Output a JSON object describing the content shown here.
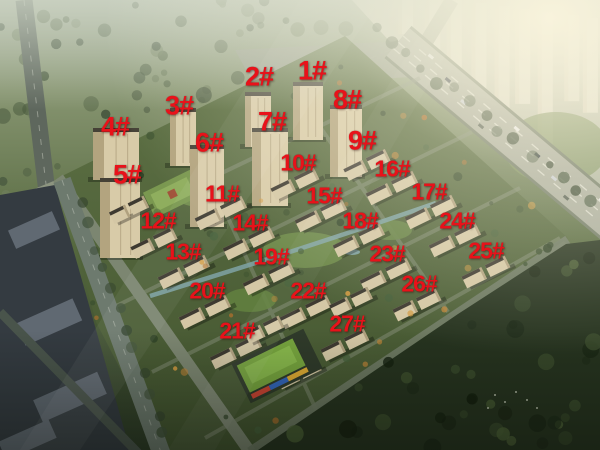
{
  "scene": {
    "type": "aerial-rendering",
    "subject": "residential compound master plan with numbered buildings",
    "marker_color": "#e8121a",
    "marker_count": 27
  },
  "markers": [
    {
      "id": 1,
      "label": "1#",
      "x": 312,
      "y": 71
    },
    {
      "id": 2,
      "label": "2#",
      "x": 259,
      "y": 77
    },
    {
      "id": 3,
      "label": "3#",
      "x": 179,
      "y": 106
    },
    {
      "id": 4,
      "label": "4#",
      "x": 115,
      "y": 127
    },
    {
      "id": 5,
      "label": "5#",
      "x": 127,
      "y": 175
    },
    {
      "id": 6,
      "label": "6#",
      "x": 209,
      "y": 143
    },
    {
      "id": 7,
      "label": "7#",
      "x": 272,
      "y": 122
    },
    {
      "id": 8,
      "label": "8#",
      "x": 347,
      "y": 100
    },
    {
      "id": 9,
      "label": "9#",
      "x": 362,
      "y": 141
    },
    {
      "id": 10,
      "label": "10#",
      "x": 298,
      "y": 163
    },
    {
      "id": 11,
      "label": "11#",
      "x": 222,
      "y": 194
    },
    {
      "id": 12,
      "label": "12#",
      "x": 158,
      "y": 221
    },
    {
      "id": 13,
      "label": "13#",
      "x": 183,
      "y": 252
    },
    {
      "id": 14,
      "label": "14#",
      "x": 250,
      "y": 223
    },
    {
      "id": 15,
      "label": "15#",
      "x": 324,
      "y": 196
    },
    {
      "id": 16,
      "label": "16#",
      "x": 392,
      "y": 169
    },
    {
      "id": 17,
      "label": "17#",
      "x": 429,
      "y": 192
    },
    {
      "id": 18,
      "label": "18#",
      "x": 360,
      "y": 221
    },
    {
      "id": 19,
      "label": "19#",
      "x": 271,
      "y": 257
    },
    {
      "id": 20,
      "label": "20#",
      "x": 207,
      "y": 291
    },
    {
      "id": 21,
      "label": "21#",
      "x": 237,
      "y": 331
    },
    {
      "id": 22,
      "label": "22#",
      "x": 308,
      "y": 291
    },
    {
      "id": 23,
      "label": "23#",
      "x": 387,
      "y": 254
    },
    {
      "id": 24,
      "label": "24#",
      "x": 457,
      "y": 221
    },
    {
      "id": 25,
      "label": "25#",
      "x": 486,
      "y": 251
    },
    {
      "id": 26,
      "label": "26#",
      "x": 419,
      "y": 284
    },
    {
      "id": 27,
      "label": "27#",
      "x": 347,
      "y": 324
    }
  ]
}
